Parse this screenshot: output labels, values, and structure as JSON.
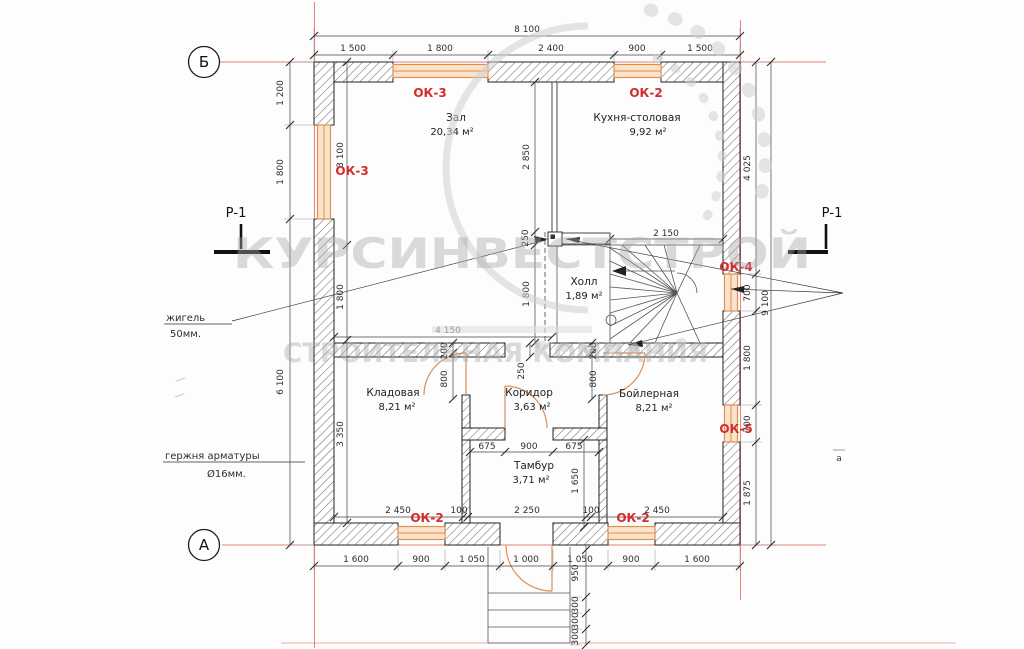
{
  "colors": {
    "accent_red": "#d42b2b",
    "axis_red": "#ec8074",
    "window_orange": "#dd8f55",
    "window_fill": "#fbe3c9",
    "watermark_gray": "#a8a8a8"
  },
  "axes": {
    "top": "Б",
    "bottom": "А",
    "right_small": "а"
  },
  "sections": {
    "left": "Р-1",
    "right": "Р-1"
  },
  "watermark": {
    "line1": "КУРСИНВЕСТСТРОЙ",
    "line2": "СТРОИТЕЛЬНАЯ КОМПАНИЯ"
  },
  "annotations": {
    "note1_line1": "жигель",
    "note1_line2": "50мм.",
    "note2_line1": "гержня арматуры",
    "note2_line2": "Ø16мм."
  },
  "rooms": {
    "zal": {
      "name": "Зал",
      "area": "20,34 м²"
    },
    "kitchen": {
      "name": "Кухня-столовая",
      "area": "9,92 м²"
    },
    "hall": {
      "name": "Холл",
      "area": "1,89 м²"
    },
    "storage": {
      "name": "Кладовая",
      "area": "8,21 м²"
    },
    "corridor": {
      "name": "Коридор",
      "area": "3,63 м²"
    },
    "boiler": {
      "name": "Бойлерная",
      "area": "8,21 м²"
    },
    "tambur": {
      "name": "Тамбур",
      "area": "3,71 м²"
    }
  },
  "windows": {
    "top1": "ОК-3",
    "top2": "ОК-2",
    "left": "ОК-3",
    "right_top": "ОК-4",
    "right_bottom": "ОК-5",
    "bottom_left": "ОК-2",
    "bottom_right": "ОК-2"
  },
  "dims": {
    "top_total": "8 100",
    "top": [
      "1 500",
      "1 800",
      "2 400",
      "900",
      "1 500"
    ],
    "bottom": [
      "1 600",
      "900",
      "1 050",
      "1 000",
      "1 050",
      "900",
      "1 600"
    ],
    "left_outer": [
      "1 200",
      "1 800",
      "6 100"
    ],
    "left_inner": [
      "3 100",
      "1 800",
      "3 350"
    ],
    "right_inner": [
      "4 025",
      "700",
      "1 800",
      "700",
      "1 875"
    ],
    "right_total": "9 100",
    "interior": {
      "zal_h": "2 850",
      "hall_gap": "250",
      "hall_h": "1 800",
      "stairs_w": "2 150",
      "storage_w": "4 150",
      "corr_gap": "250",
      "door1_off": "200",
      "door1_w": "800",
      "door2_off": "200",
      "door2_w": "800",
      "tambur_chain": [
        "675",
        "900",
        "675"
      ],
      "tambur_h": "1 650",
      "inner_bottom": [
        "2 450",
        "100",
        "2 250",
        "100",
        "2 450"
      ],
      "porch": [
        "950",
        "300",
        "300",
        "300"
      ]
    }
  }
}
